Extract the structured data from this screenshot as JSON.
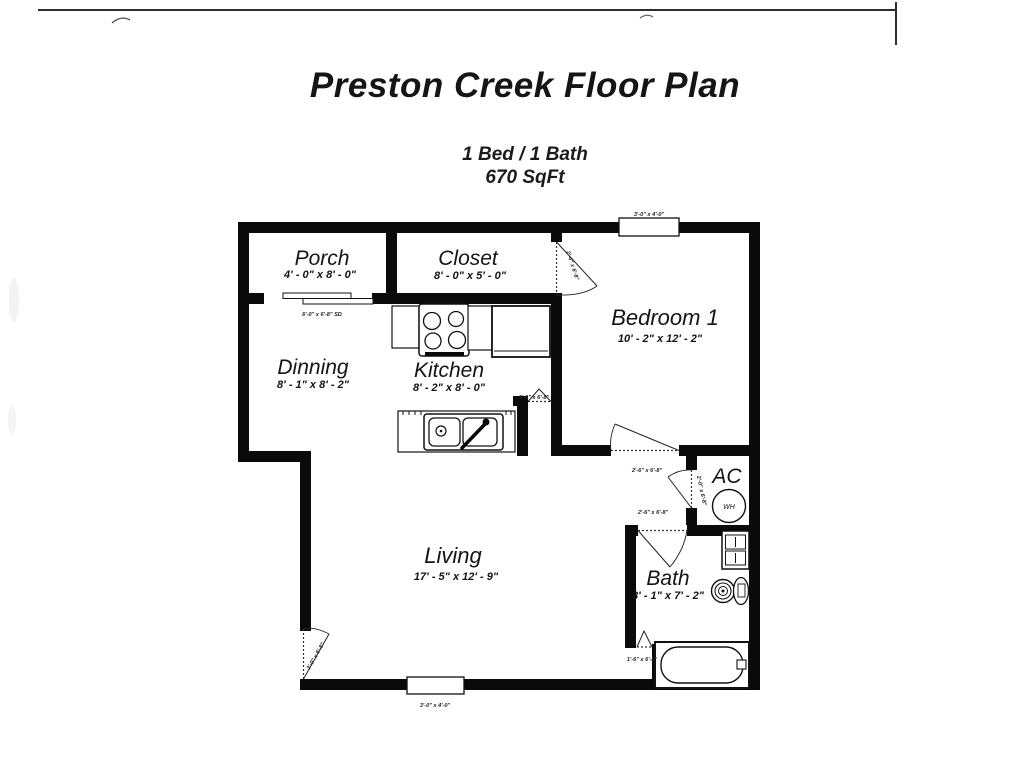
{
  "page": {
    "title": "Preston Creek Floor Plan",
    "subtitle_line1": "1 Bed / 1 Bath",
    "subtitle_line2": "670 SqFt"
  },
  "rooms": {
    "porch": {
      "name": "Porch",
      "dims": "4' - 0\" x 8' - 0\""
    },
    "closet": {
      "name": "Closet",
      "dims": "8' - 0\" x 5' - 0\""
    },
    "bedroom1": {
      "name": "Bedroom 1",
      "dims": "10' - 2\" x 12' - 2\""
    },
    "dinning": {
      "name": "Dinning",
      "dims": "8' - 1\" x 8' - 2\""
    },
    "kitchen": {
      "name": "Kitchen",
      "dims": "8' - 2\" x 8' - 0\""
    },
    "living": {
      "name": "Living",
      "dims": "17' - 5\" x 12' - 9\""
    },
    "bath": {
      "name": "Bath",
      "dims": "8' - 1\" x 7' - 2\""
    },
    "ac": {
      "name": "AC"
    },
    "water_heater": {
      "name": "WH"
    }
  },
  "annotations": {
    "window_top": "3'-0\" x 4'-0\"",
    "window_bottom": "3'-0\" x 4'-0\"",
    "sliding_door": "6'-0\" x 6'-8\" SD",
    "closet_door": "2'-4\" x 6'-8\"",
    "bedroom_door": "2'-6\" x 6'-8\"",
    "ac_door": "2'-0\" x 6'-8\"",
    "bath_door": "2'-6\" x 6'-8\"",
    "pantry_door": "1'-6\" x 6'-8\"",
    "linen_door": "1'-6\" x 6'-8\"",
    "entry_door": "3'-0\" x 6'-8\""
  },
  "colors": {
    "wall": "#0a0a0a",
    "text": "#141414"
  }
}
